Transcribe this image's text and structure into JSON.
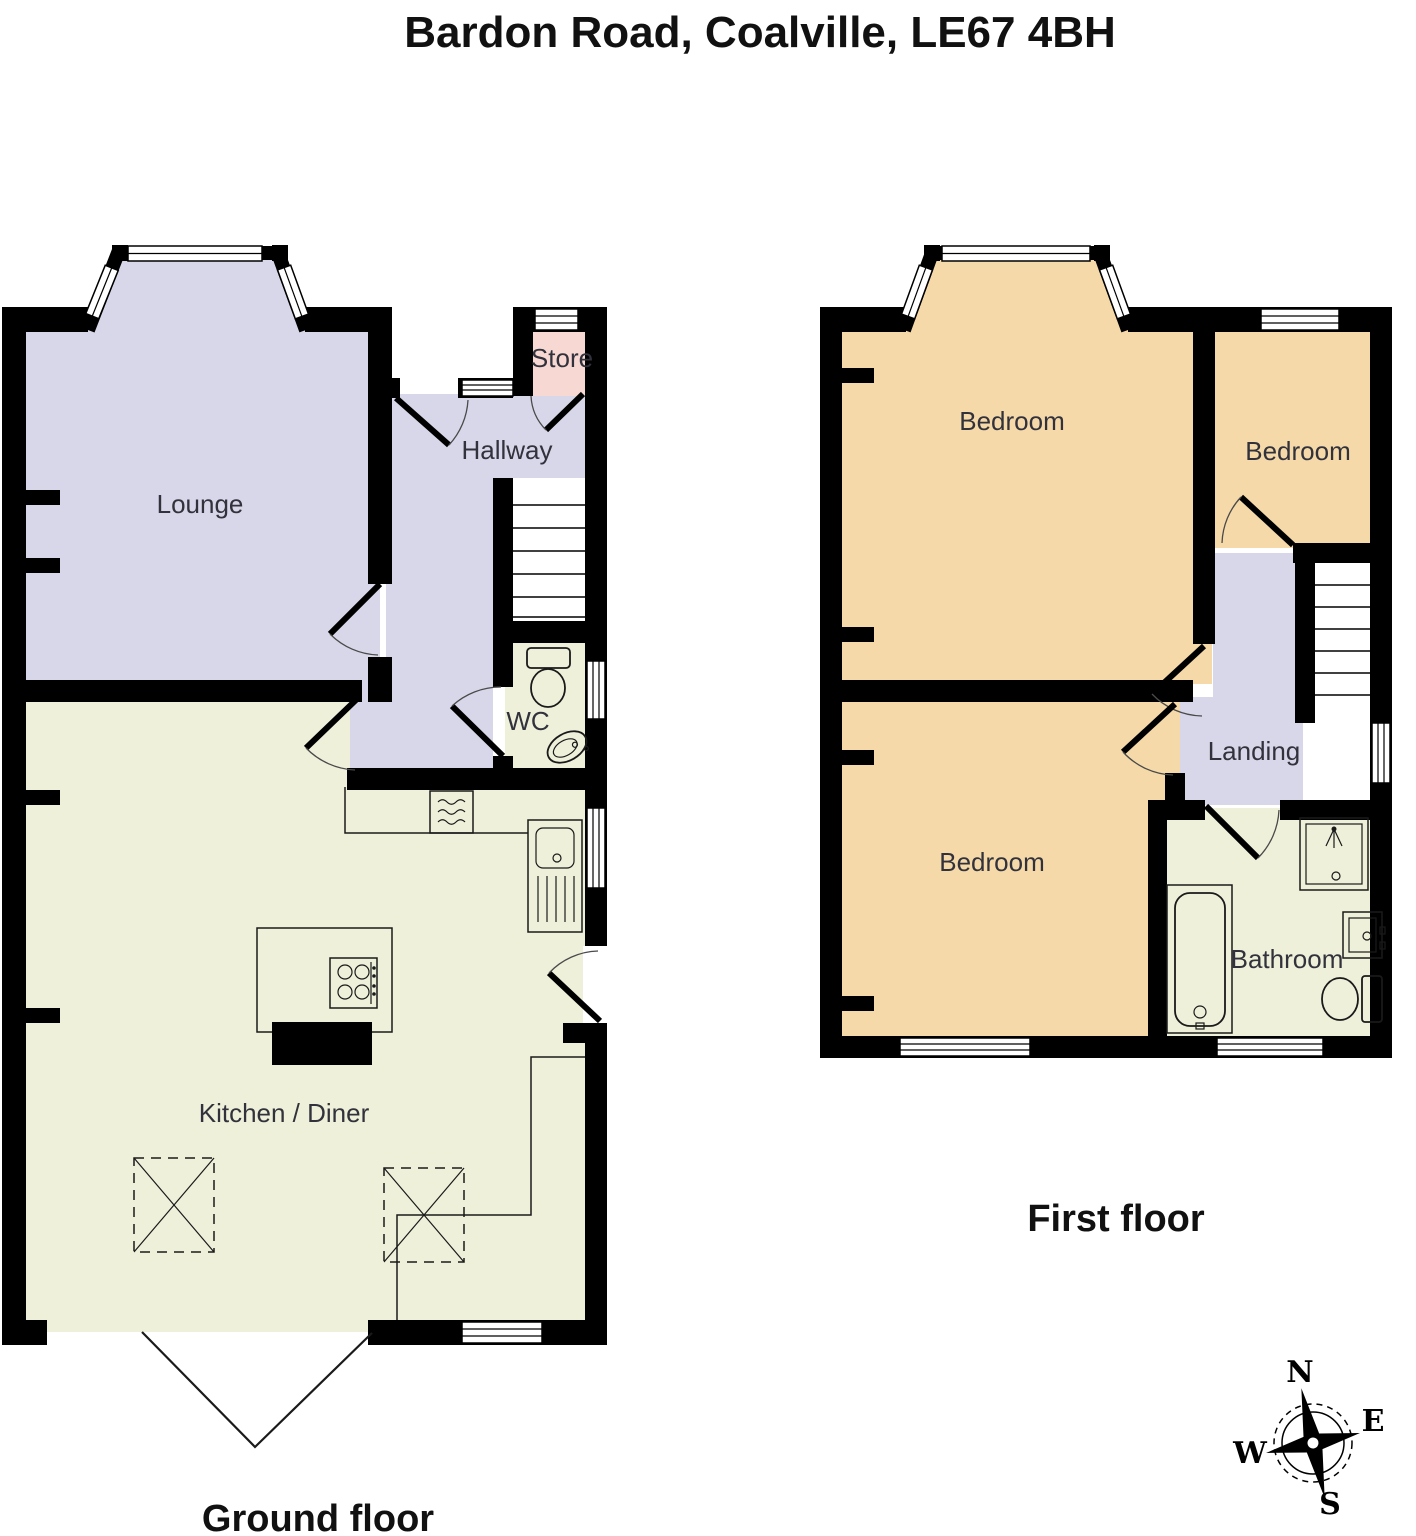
{
  "title": "Bardon Road, Coalville, LE67 4BH",
  "ground_floor": {
    "caption": "Ground floor",
    "rooms": {
      "lounge": "Lounge",
      "hallway": "Hallway",
      "store": "Store",
      "wc": "WC",
      "kitchen_diner": "Kitchen / Diner"
    }
  },
  "first_floor": {
    "caption": "First floor",
    "rooms": {
      "bedroom_front": "Bedroom",
      "bedroom_small": "Bedroom",
      "bedroom_rear": "Bedroom",
      "landing": "Landing",
      "bathroom": "Bathroom"
    }
  },
  "compass": {
    "north": "N",
    "east": "E",
    "south": "S",
    "west": "W"
  },
  "palette": {
    "room_purple": "#d7d7e9",
    "room_cream": "#eef0da",
    "room_tan": "#f5d9a9",
    "room_pink": "#f7d8d3",
    "wall": "#000000",
    "label": "#32323c"
  }
}
